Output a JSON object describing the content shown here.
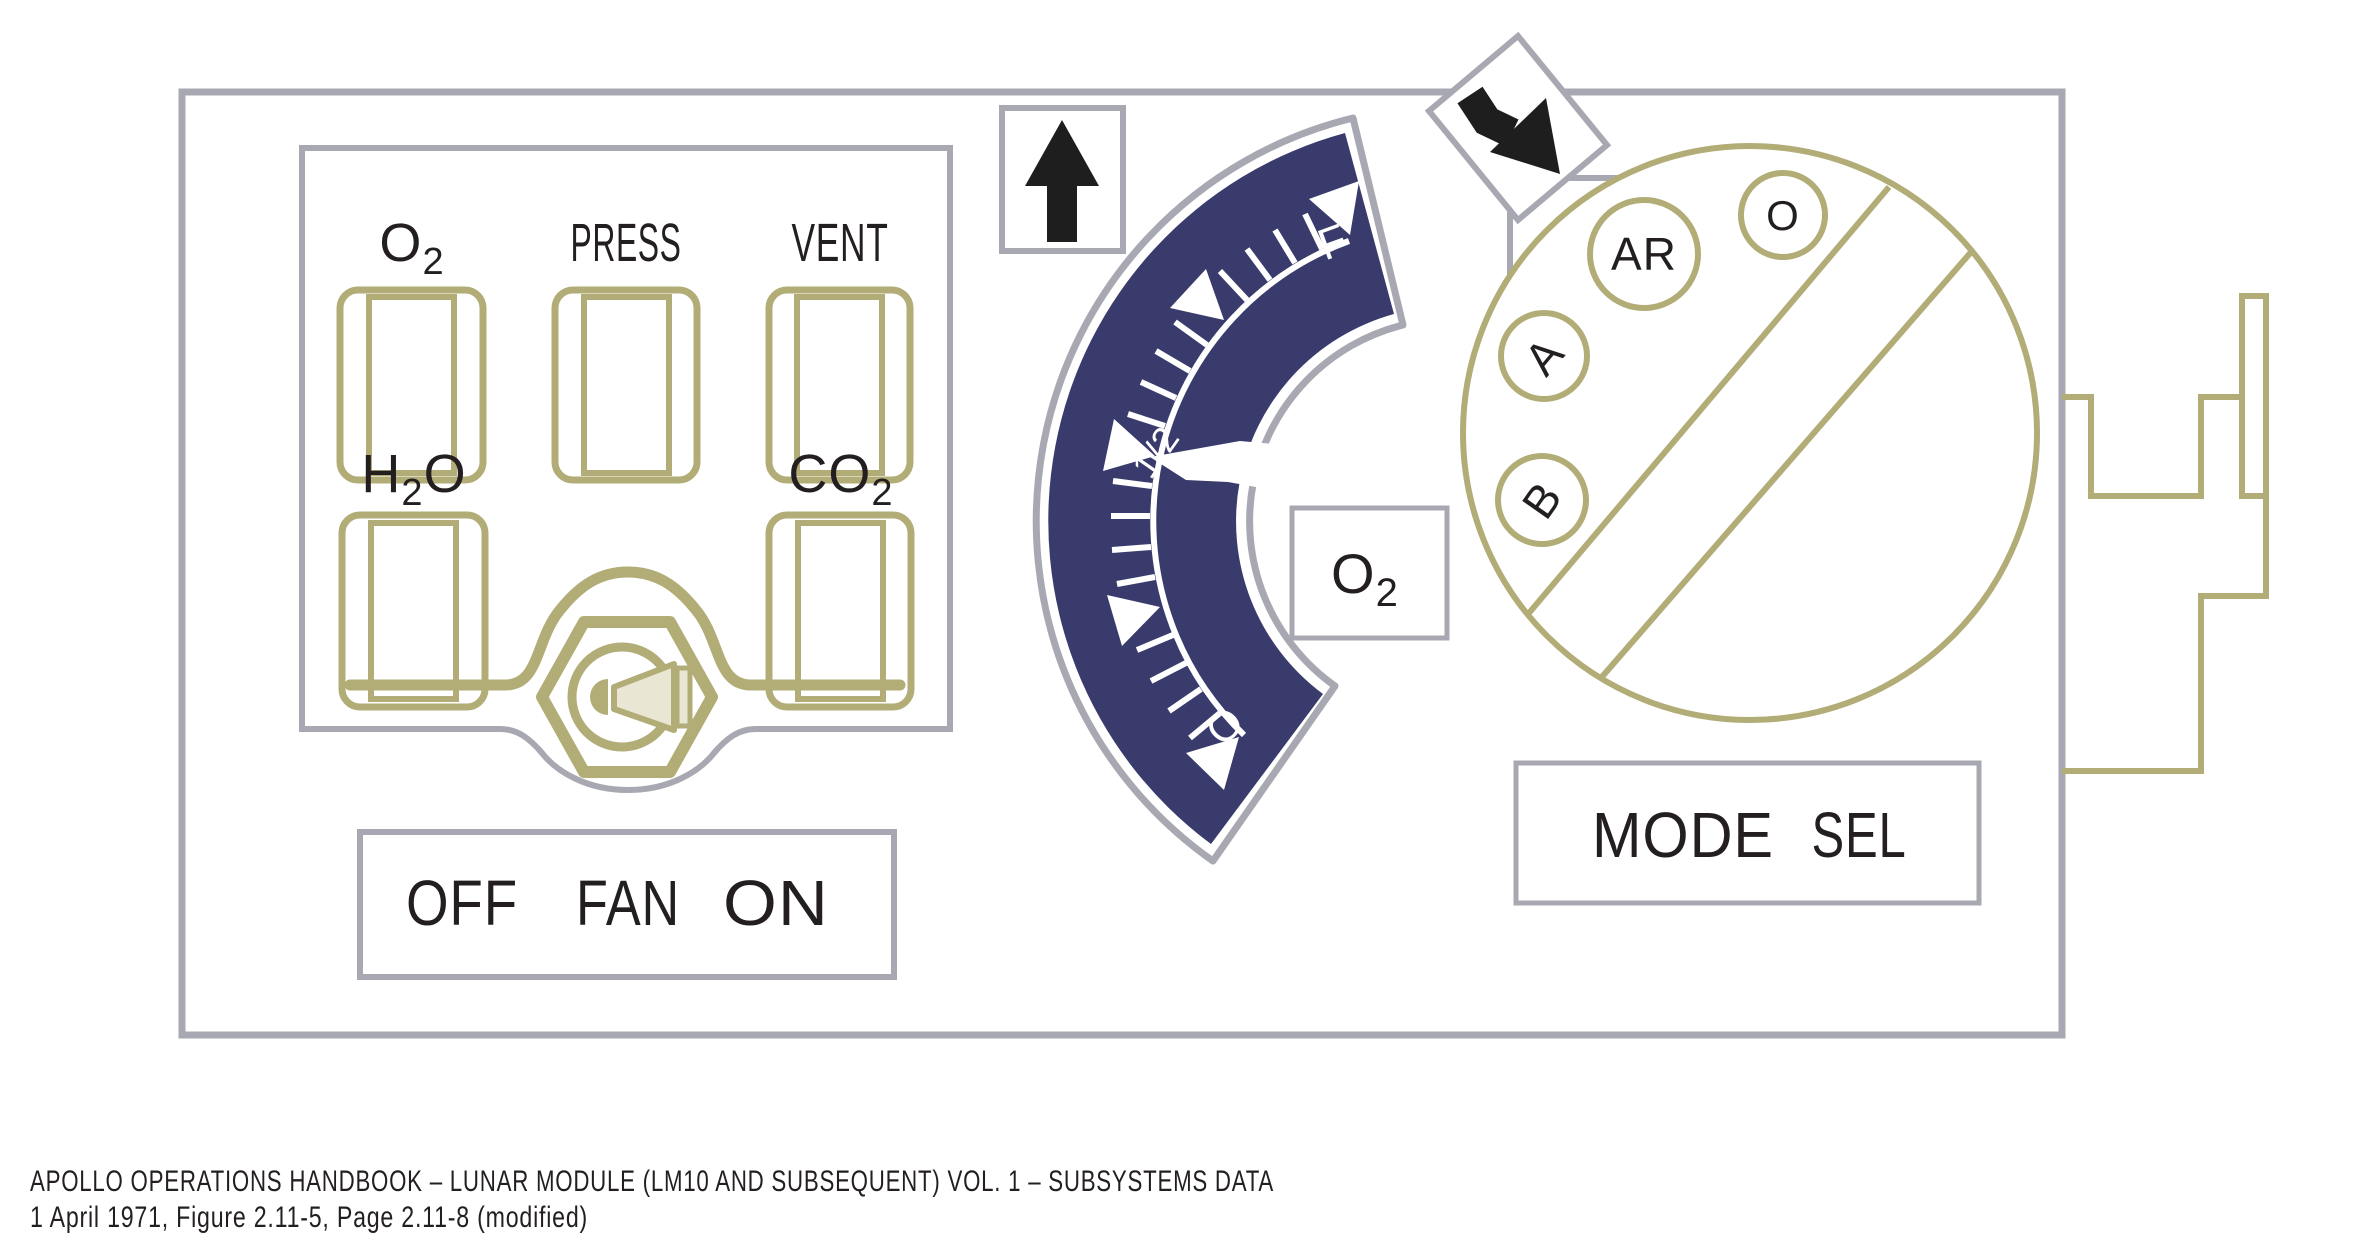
{
  "figure": {
    "caption_line1": "APOLLO OPERATIONS HANDBOOK – LUNAR MODULE (LM10 AND SUBSEQUENT) VOL. 1 – SUBSYSTEMS DATA",
    "caption_line2": "1 April 1971, Figure 2.11-5, Page 2.11-8 (modified)"
  },
  "status_panel": {
    "indicators": [
      {
        "id": "o2",
        "pre": "O",
        "sub": "2",
        "post": ""
      },
      {
        "id": "press",
        "pre": "PRESS",
        "sub": "",
        "post": ""
      },
      {
        "id": "vent",
        "pre": "VENT",
        "sub": "",
        "post": ""
      },
      {
        "id": "h2o",
        "pre": "H",
        "sub": "2",
        "post": "O"
      },
      {
        "id": "co2",
        "pre": "CO",
        "sub": "2",
        "post": ""
      }
    ],
    "fan_switch": {
      "off": "OFF",
      "fan": "FAN",
      "on": "ON"
    }
  },
  "gauge": {
    "label_pre": "O",
    "label_sub": "2",
    "scale": {
      "full": "F",
      "half": "1/2",
      "zero": "O"
    },
    "needle_position": "1/2"
  },
  "mode_selector": {
    "label_word1": "MODE",
    "label_word2": "SEL",
    "positions": {
      "ar": "AR",
      "o": "O",
      "a": "A",
      "b": "B"
    }
  },
  "colors": {
    "navy": "#3a3b6d",
    "olive": "#b2ac77",
    "panel_gray": "#a8a8b2",
    "knob_beige": "#e9e6d3",
    "ink": "#231f20"
  }
}
